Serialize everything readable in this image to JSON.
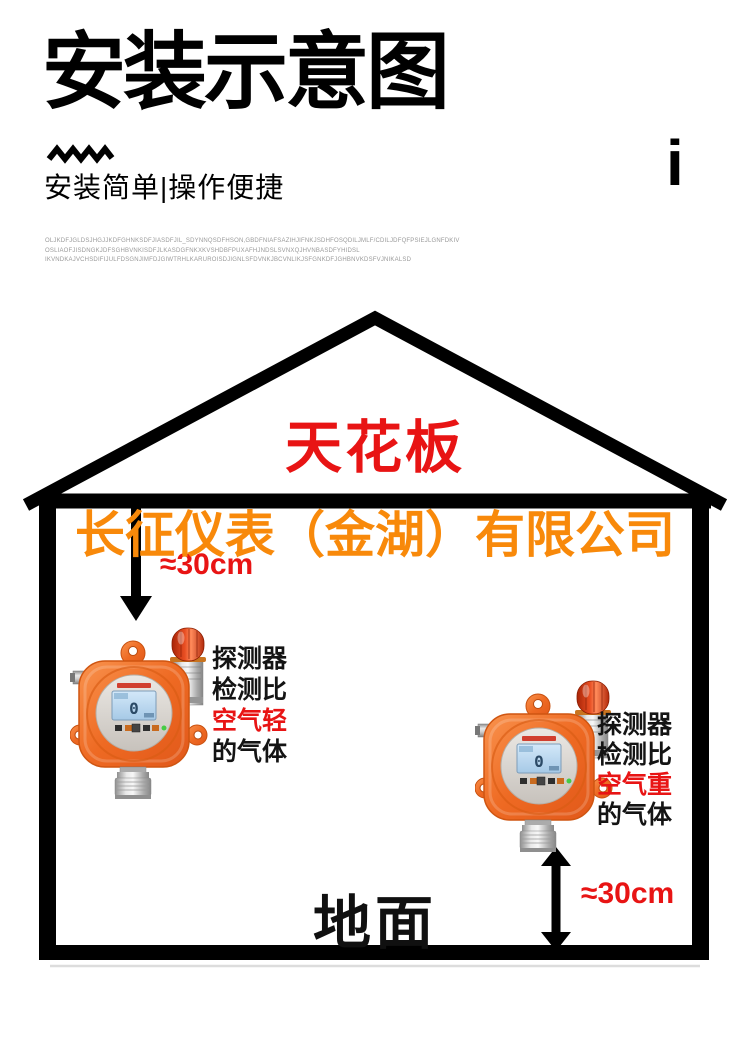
{
  "header": {
    "title": "安装示意图",
    "tagline": "安装简单|操作便捷",
    "info_mark": "i",
    "fine_print": [
      "OLJKDFJGLDSJHGJJKDFGHNKSDFJIASDFJIL_SDYNNQSDFHSON,GBDFNIAFSAZIHJIFNKJSDHFOSQDILJMLF/CDILJDFQFPSIEJLGNFDKIV",
      "OSLIAOFJISDNGKJDFSGHBVNKISDFJLKASDGFNKXKVSHDBFPUXAFHJNDSLSVNXQJHVNBASDFYHIDSL",
      "IKVNDKAJVCHSDIFIJULFDSGNJIMFDJGIWTRHLKARUROISDJIGNLSFDVNKJBCVNLIKJSFGNKDFJGHBNVKDSFVJNIKALSD"
    ]
  },
  "diagram": {
    "ceiling_label": "天花板",
    "company_watermark": "长征仪表（金湖）有限公司",
    "floor_label": "地面",
    "top_distance": "≈30cm",
    "bottom_distance": "≈30cm",
    "left_caption": [
      "探测器",
      "检测比",
      "空气轻",
      "的气体"
    ],
    "right_caption": [
      "探测器",
      "检测比",
      "空气重",
      "的气体"
    ],
    "detector_display": "0"
  },
  "colors": {
    "accent_red": "#e81414",
    "watermark_orange": "#f8890a",
    "line_black": "#000000",
    "device_orange": "#ee6a23"
  }
}
